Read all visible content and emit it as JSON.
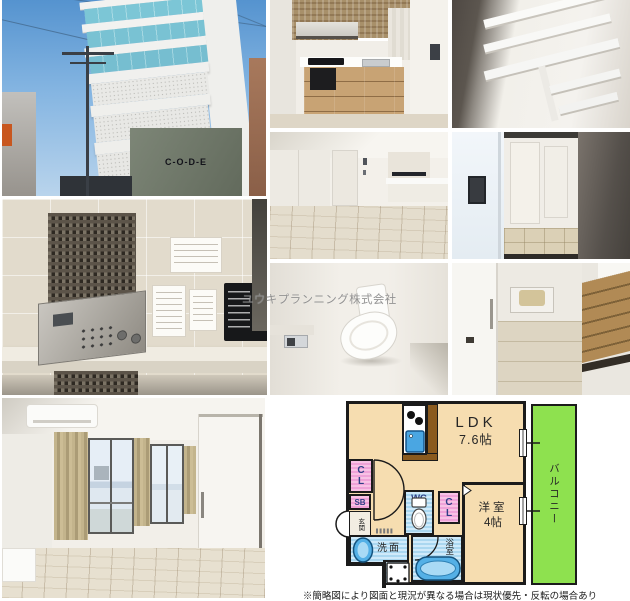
{
  "watermark": {
    "text": "ユウキプランニング株式会社"
  },
  "building_photo": {
    "sign_text": "C-O-D-E"
  },
  "floorplan": {
    "ldk": {
      "label": "LDK",
      "size": "7.6帖"
    },
    "bedroom": {
      "label": "洋室",
      "size": "4帖"
    },
    "balcony": {
      "label": "バルコニー"
    },
    "closet_top": {
      "label": "CL"
    },
    "closet_bedroom": {
      "label": "CL"
    },
    "shoe_box": {
      "label": "SB"
    },
    "entrance": {
      "label": "玄関"
    },
    "wc": {
      "label": "WC"
    },
    "washroom": {
      "label": "洗面"
    },
    "bathroom": {
      "label": "浴室"
    },
    "colors": {
      "room_fill": "#f6ddb0",
      "closet_fill": "#efa2d8",
      "wet_area_fill": "#aad7f0",
      "balcony_fill": "#8ee14f",
      "wall": "#1b1b1b",
      "fixture_blue": "#54b0e6"
    }
  },
  "footnote": "※簡略図により図面と現況が異なる場合は現状優先・反転の場合あり"
}
